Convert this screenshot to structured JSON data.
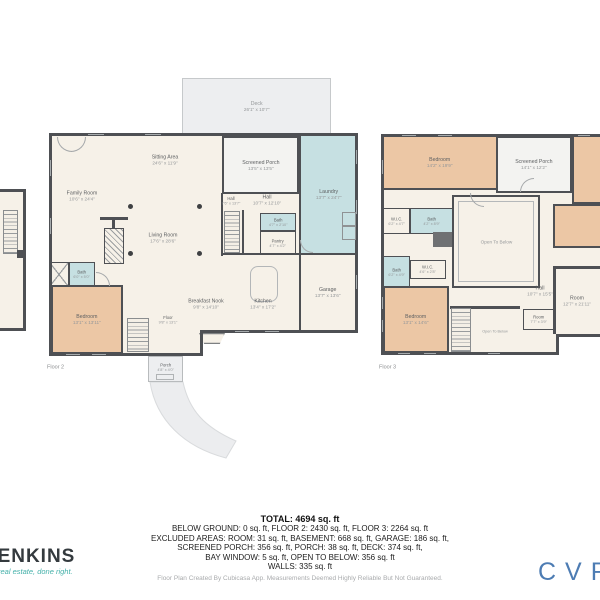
{
  "floor2": {
    "plan_label": "Floor 2",
    "rooms": {
      "deck": {
        "name": "Deck",
        "dims": "26'1\" x 10'7\""
      },
      "sitting_area": {
        "name": "Sitting Area",
        "dims": "24'6\" x 11'9\""
      },
      "family_room": {
        "name": "Family Room",
        "dims": "10'6\" x 24'4\""
      },
      "living_room": {
        "name": "Living Room",
        "dims": "17'6\" x 28'6\""
      },
      "screened_porch": {
        "name": "Screened Porch",
        "dims": "13'5\" x 13'5\""
      },
      "laundry": {
        "name": "Laundry",
        "dims": "13'7\" x 24'7\""
      },
      "hall": {
        "name": "Hall",
        "dims": "10'7\" x 12'10\""
      },
      "hall_stairs": {
        "name": "Hall",
        "dims": "7'6\" x 13'7\""
      },
      "bath_small": {
        "name": "Bath",
        "dims": "4'7\" x 2'10\""
      },
      "pantry": {
        "name": "Pantry",
        "dims": "4'7\" x 4'2\""
      },
      "bath": {
        "name": "Bath",
        "dims": "6'0\" x 5'0\""
      },
      "bedroom": {
        "name": "Bedroom",
        "dims": "13'1\" x 13'11\""
      },
      "breakfast_nook": {
        "name": "Breakfast Nook",
        "dims": "9'8\" x 14'10\""
      },
      "kitchen": {
        "name": "Kitchen",
        "dims": "13'4\" x 17'2\""
      },
      "garage": {
        "name": "Garage",
        "dims": "13'7\" x 13'6\""
      },
      "floor_area": {
        "name": "Floor",
        "dims": "9'8\" x 13'1\""
      },
      "porch": {
        "name": "Porch",
        "dims": "4'8\" x 4'0\""
      }
    }
  },
  "floor3": {
    "plan_label": "Floor 3",
    "rooms": {
      "bedroom_top": {
        "name": "Bedroom",
        "dims": "14'2\" x 19'9\""
      },
      "screened_porch": {
        "name": "Screened Porch",
        "dims": "14'1\" x 12'2\""
      },
      "wic_top": {
        "name": "W.I.C.",
        "dims": "6'2\" x 4'7\""
      },
      "bath_mid": {
        "name": "Bath",
        "dims": "4'2\" x 8'9\""
      },
      "open_to_below": {
        "name": "Open To Below"
      },
      "bath_left": {
        "name": "Bath",
        "dims": "6'2\" x 4'9\""
      },
      "wic_small": {
        "name": "W.I.C.",
        "dims": "4'6\" x 2'8\""
      },
      "bedroom_bottom": {
        "name": "Bedroom",
        "dims": "13'1\" x 14'6\""
      },
      "open_to_below_stairs": {
        "name": "Open To Below"
      },
      "hall": {
        "name": "Hall",
        "dims": "10'7\" x 15'5\""
      },
      "room_right": {
        "name": "Room",
        "dims": "12'7\" x 21'11\""
      },
      "room_small": {
        "name": "Room",
        "dims": "7'7\" x 3'9\""
      }
    }
  },
  "summary": {
    "total": "TOTAL: 4694 sq. ft",
    "line1": "BELOW GROUND: 0 sq. ft, FLOOR 2: 2430 sq. ft, FLOOR 3: 2264 sq. ft",
    "line2": "EXCLUDED AREAS: ROOM: 31 sq. ft, BASEMENT: 668 sq. ft, GARAGE: 186 sq. ft,",
    "line3": "SCREENED PORCH: 356 sq. ft, PORCH: 38 sq. ft, DECK: 374 sq. ft,",
    "line4": "BAY WINDOW: 5 sq. ft, OPEN TO BELOW: 356 sq. ft",
    "line5": "WALLS: 335 sq. ft"
  },
  "footer": {
    "disclaimer": "Floor Plan Created By Cubicasa App. Measurements Deemed Highly Reliable But Not Guaranteed."
  },
  "branding": {
    "agency_name": "JENKINS",
    "agency_tagline": "real estate, done right.",
    "right_logo": "CVR"
  },
  "colors": {
    "wall": "#4e5054",
    "floor_fill": "#f6f1e8",
    "bedroom_fill": "#ecc7a5",
    "wet_room_fill": "#c6e0e2",
    "deck_fill": "#edeef0",
    "logo_teal": "#43b0a9",
    "logo_blue": "#4d7cb3"
  }
}
